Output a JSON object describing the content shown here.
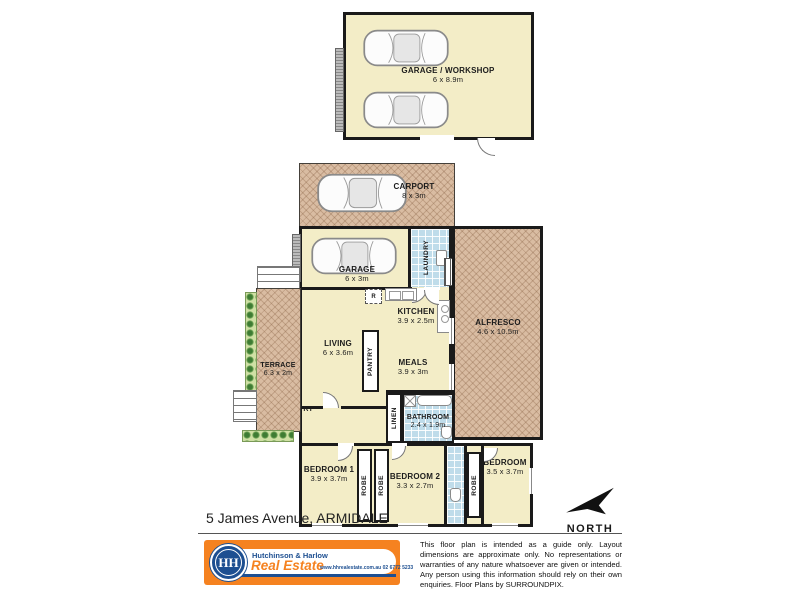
{
  "plan": {
    "address": "5 James Avenue, ARMIDALE",
    "north_label": "NORTH",
    "labels": {
      "robe": "ROBE",
      "entry": "ENTRY",
      "laundry": "LAUNDRY",
      "pantry": "PANTRY",
      "linen": "LINEN",
      "fridge": "R"
    },
    "rooms": {
      "garage_workshop": {
        "name": "GARAGE / WORKSHOP",
        "dims": "6 x 8.9m"
      },
      "carport": {
        "name": "CARPORT",
        "dims": "8 x 3m"
      },
      "garage": {
        "name": "GARAGE",
        "dims": "6 x 3m"
      },
      "alfresco": {
        "name": "ALFRESCO",
        "dims": "4.6 x 10.5m"
      },
      "kitchen": {
        "name": "KITCHEN",
        "dims": "3.9 x 2.5m"
      },
      "living": {
        "name": "LIVING",
        "dims": "6 x 3.6m"
      },
      "meals": {
        "name": "MEALS",
        "dims": "3.9 x 3m"
      },
      "terrace": {
        "name": "TERRACE",
        "dims": "6.3 x 2m"
      },
      "bathroom": {
        "name": "BATHROOM",
        "dims": "2.4 x 1.9m"
      },
      "bedroom1": {
        "name": "BEDROOM 1",
        "dims": "3.9 x 3.7m"
      },
      "bedroom2": {
        "name": "BEDROOM 2",
        "dims": "3.3 x 2.7m"
      },
      "bedroom3": {
        "name": "BEDROOM",
        "dims": "3.5 x 3.7m"
      }
    },
    "footer": {
      "agency_name": "Hutchinson & Harlow",
      "agency_tagline": "Real Estate",
      "agency_contact": "www.hhrealestate.com.au  02 6772 5233",
      "logo_monogram": "HH",
      "disclaimer": "This floor plan is intended as a guide only. Layout dimensions are approximate only. No representations or warranties of any nature whatsoever are given or intended. Any person using this information should rely on their own enquiries. Floor Plans by  SURROUNDPIX."
    },
    "colors": {
      "accent_orange": "#F58220",
      "brand_blue": "#1D4F91",
      "room_cream": "#F3EDC7",
      "hatch_brown": "#D9BCA2",
      "tile_blue": "#BFDCEA",
      "wall": "#1A1A1A",
      "garden_green": "#3E7C33",
      "garden_light": "#CFE0A4"
    }
  }
}
